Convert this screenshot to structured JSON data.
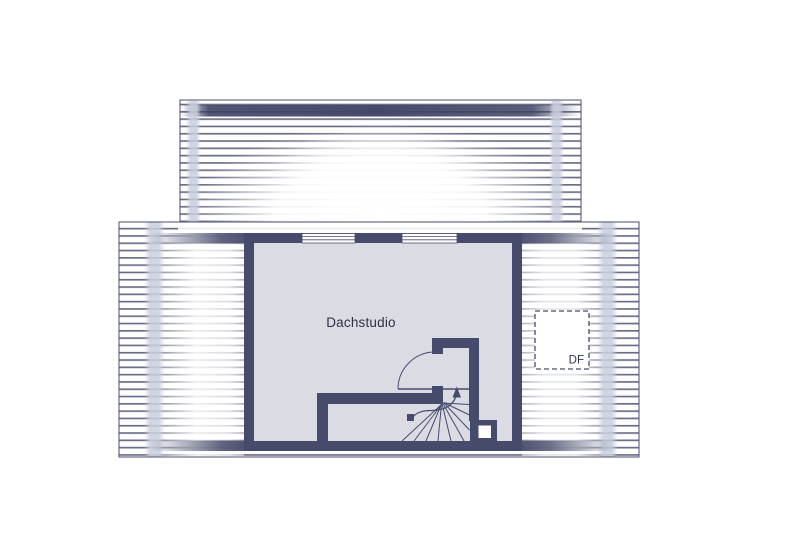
{
  "labels": {
    "room": "Dachstudio",
    "roof_window": "DF"
  },
  "colors": {
    "background": "#ffffff",
    "wall": "#474b6b",
    "hatch_line": "#4a4e6e",
    "dark_band": "#3e4263",
    "room_floor": "#dbdce3",
    "tint_band": "#c9cede",
    "text": "#2e3040"
  }
}
